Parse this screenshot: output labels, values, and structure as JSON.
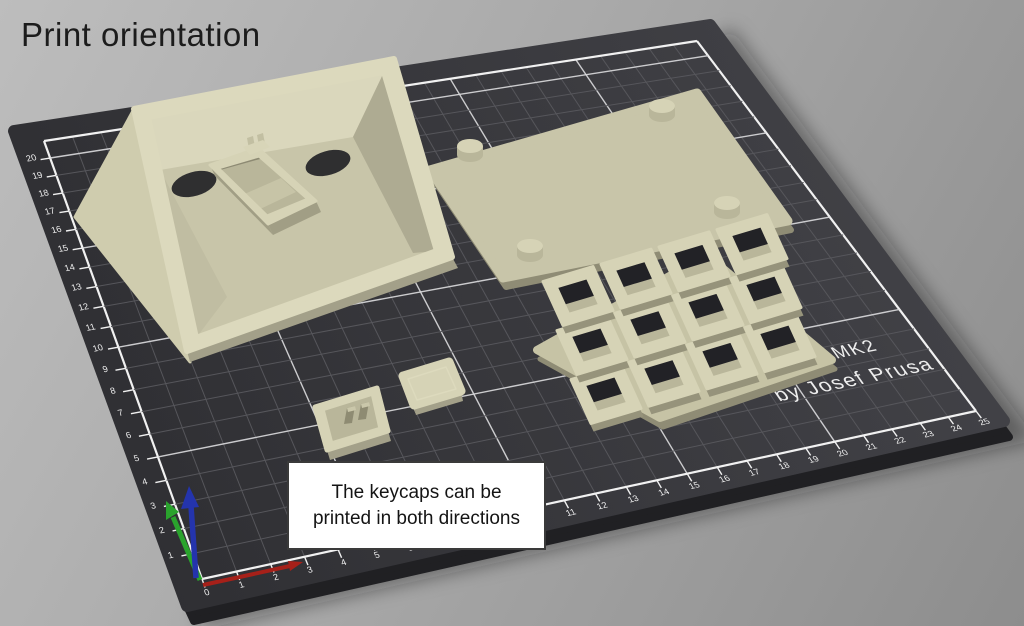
{
  "title": "Print orientation",
  "annotation": {
    "line1": "The keycaps can be",
    "line2": "printed in both directions"
  },
  "bed": {
    "brand_line1": "MK2",
    "brand_line2": "by Josef Prusa",
    "x_ticks": [
      0,
      1,
      2,
      3,
      4,
      5,
      6,
      7,
      8,
      9,
      10,
      11,
      12,
      13,
      14,
      15,
      16,
      17,
      18,
      19,
      20,
      21,
      22,
      23,
      24,
      25
    ],
    "y_ticks": [
      1,
      2,
      3,
      4,
      5,
      6,
      7,
      8,
      9,
      10,
      11,
      12,
      13,
      14,
      15,
      16,
      17,
      18,
      19,
      20
    ],
    "x_max": 25,
    "y_max": 21,
    "major_every": 5
  },
  "keypad_grid": {
    "rows": 3,
    "cols": 4
  },
  "colors": {
    "background_top": "#bdbdbd",
    "background_bottom": "#8d8d8d",
    "bed_surface_dark": "#2e2e32",
    "bed_surface_light": "#424247",
    "bed_side": "#202023",
    "grid_minor": "#56565b",
    "grid_major": "#d9d9db",
    "grid_border": "#f1f1f1",
    "ruler_text": "#efefef",
    "brand_text": "#ededed",
    "part_top": "#d6d3b6",
    "part_bright": "#dcd9bd",
    "part_light": "#cfccae",
    "part_base": "#c8c5a9",
    "part_mid": "#b9b69a",
    "part_shade": "#aeab92",
    "part_dark": "#a3a089",
    "part_deep": "#8f8c75",
    "hole_dark": "#222226",
    "axis_x": "#a62019",
    "axis_y": "#2aa32d",
    "axis_z": "#2434ac",
    "annotation_bg": "#ffffff",
    "annotation_border": "#3a3a3a",
    "annotation_text": "#141414",
    "title_text": "#1c1c1c"
  }
}
